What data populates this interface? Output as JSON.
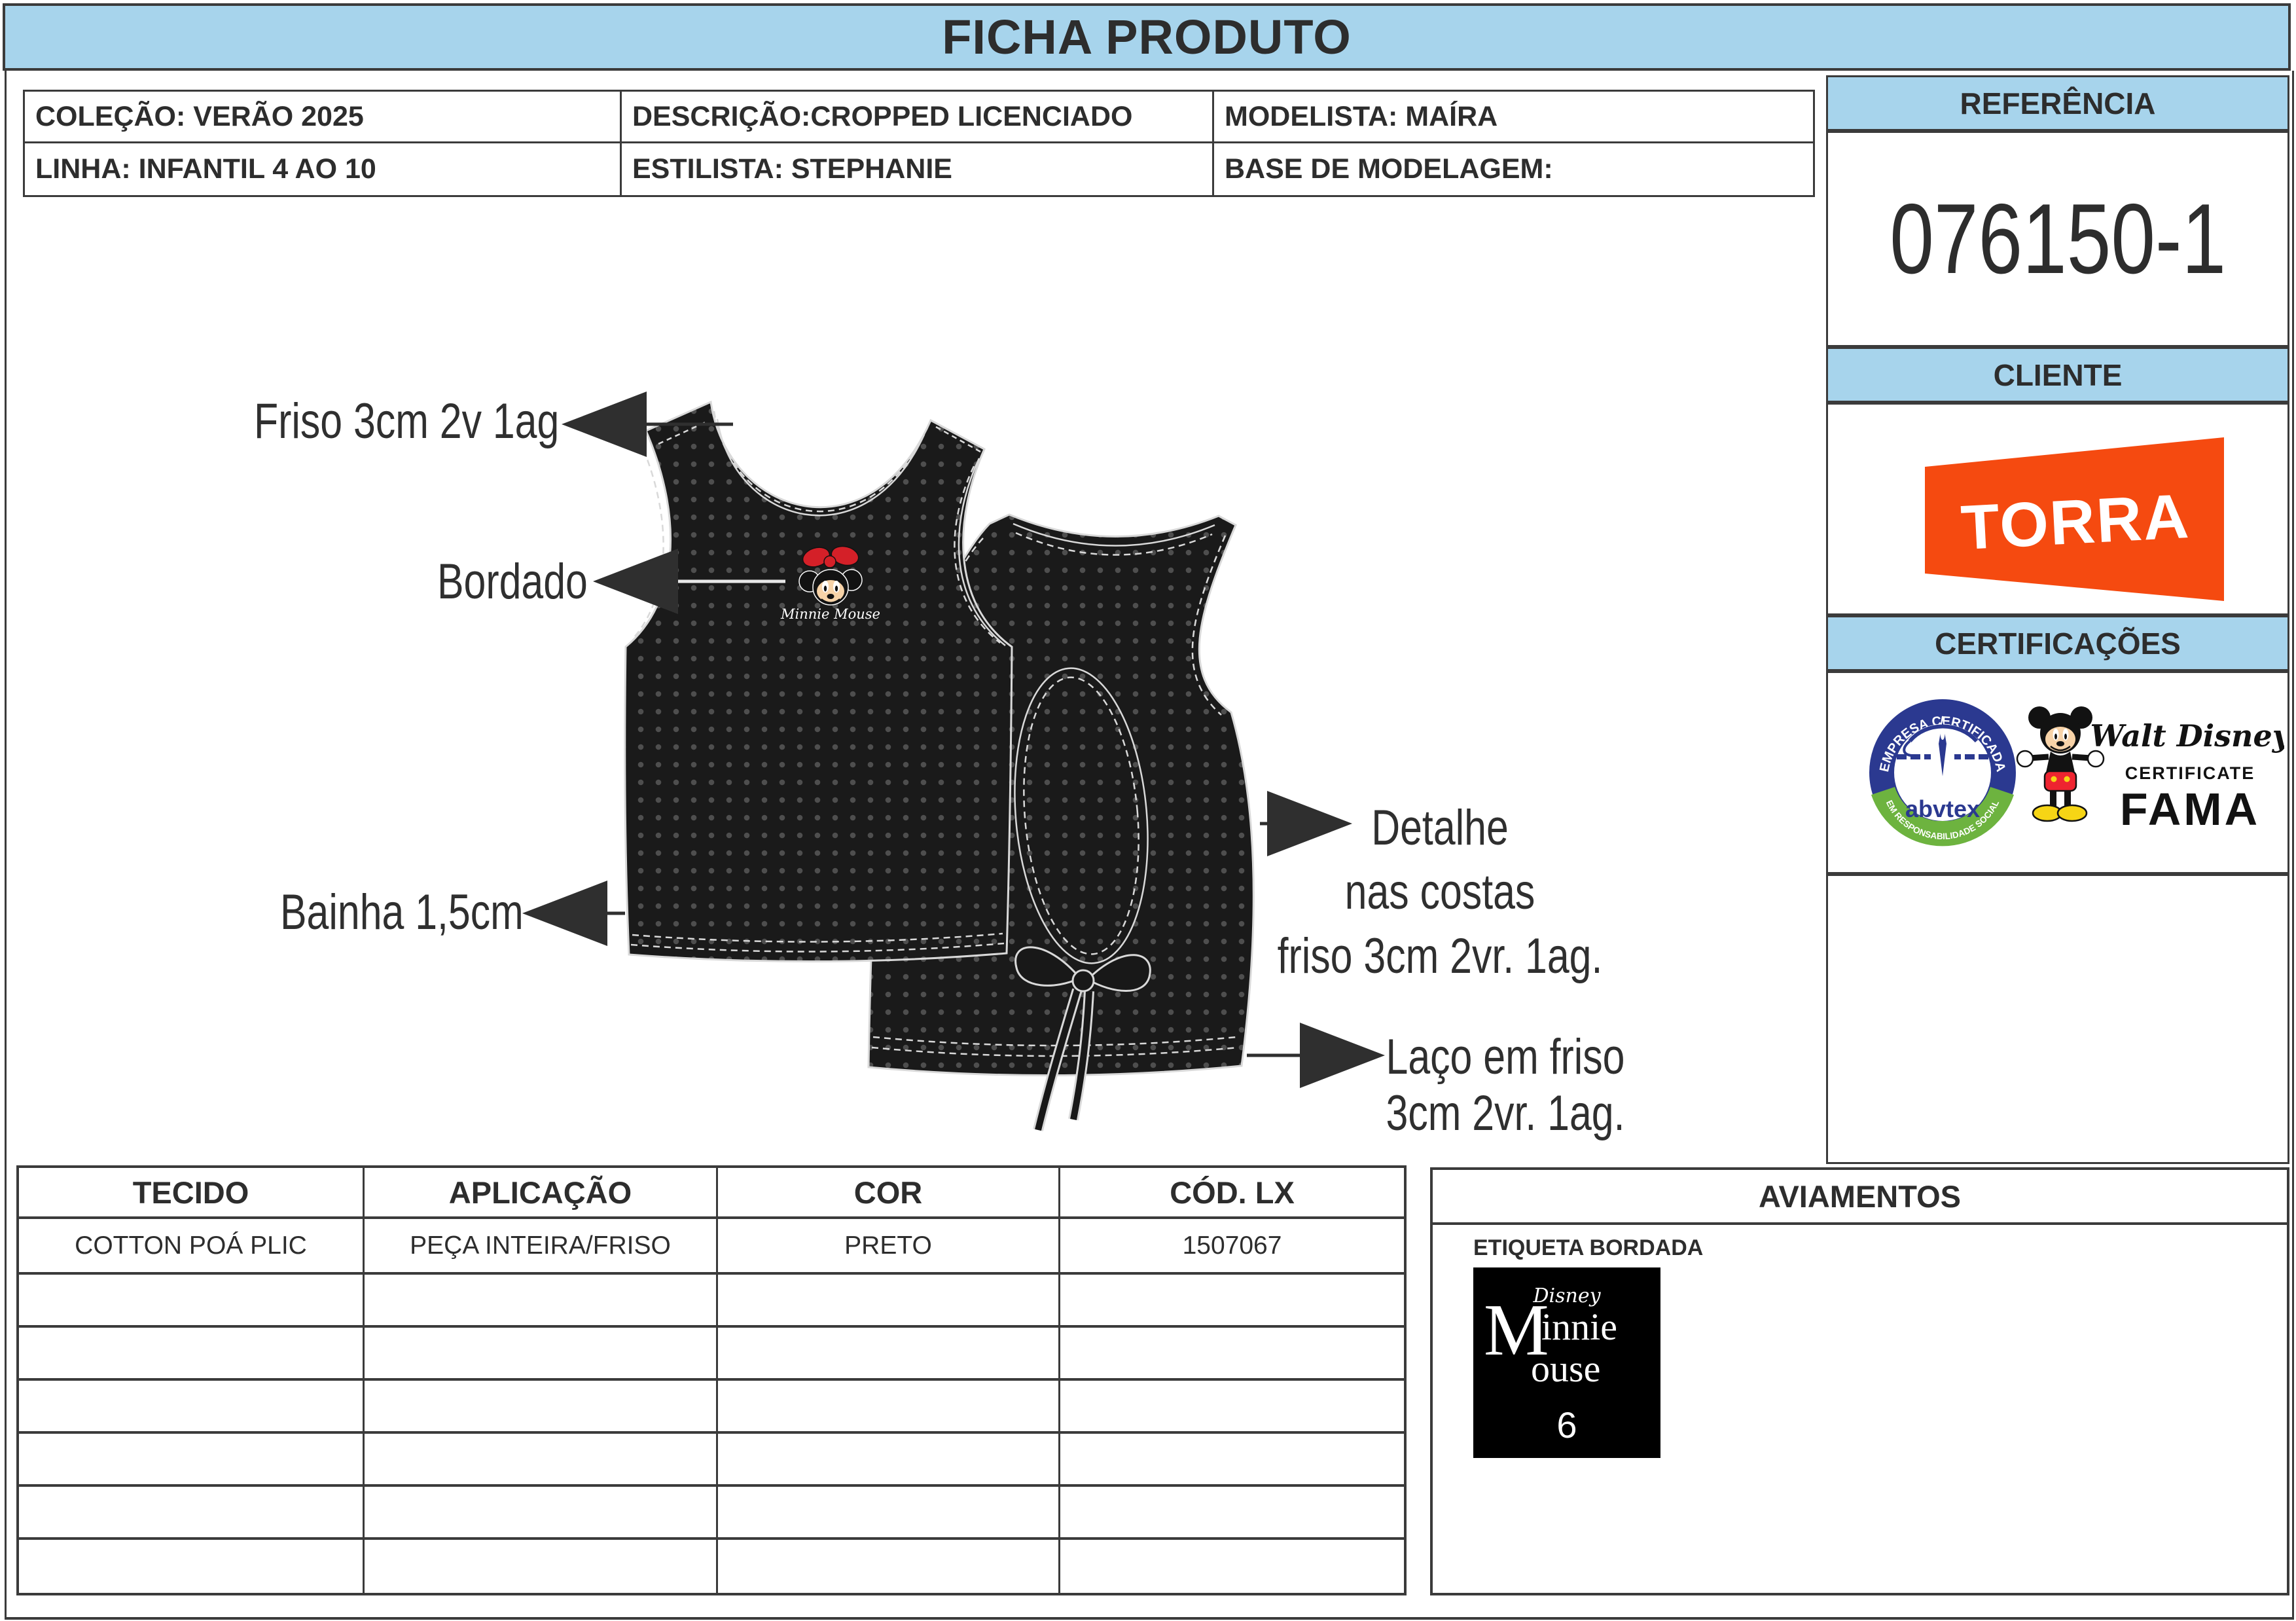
{
  "title_bar": "FICHA PRODUTO",
  "header_table": {
    "rows": [
      [
        "COLEÇÃO: VERÃO 2025",
        "DESCRIÇÃO:CROPPED LICENCIADO",
        "MODELISTA: MAÍRA"
      ],
      [
        "LINHA: INFANTIL 4 AO 10",
        "ESTILISTA: STEPHANIE",
        "BASE DE MODELAGEM:"
      ]
    ]
  },
  "sidebar": {
    "referencia": {
      "label": "REFERÊNCIA",
      "value": "076150-1"
    },
    "cliente": {
      "label": "CLIENTE",
      "logo_text": "TORRA"
    },
    "certificacoes": {
      "label": "CERTIFICAÇÕES",
      "abvtex": {
        "arc_top": "EMPRESA CERTIFICADA",
        "arc_bottom": "EM RESPONSABILIDADE SOCIAL",
        "name": "abvtex"
      },
      "fama": {
        "script": "Walt Disney",
        "line1": "CERTIFICATE",
        "line2": "FAMA"
      }
    }
  },
  "drawing": {
    "annotations": {
      "friso": "Friso 3cm 2v 1ag",
      "bordado": "Bordado",
      "bainha": "Bainha 1,5cm",
      "detalhe": [
        "Detalhe",
        "nas costas",
        "friso 3cm 2vr. 1ag."
      ],
      "laco": [
        "Laço em friso",
        "3cm 2vr. 1ag."
      ]
    },
    "embroidery": {
      "text": "Minnie Mouse"
    }
  },
  "materials_table": {
    "headers": [
      "TECIDO",
      "APLICAÇÃO",
      "COR",
      "CÓD. LX"
    ],
    "rows": [
      [
        "COTTON POÁ PLIC",
        "PEÇA INTEIRA/FRISO",
        "PRETO",
        "1507067"
      ],
      [
        "",
        "",
        "",
        ""
      ],
      [
        "",
        "",
        "",
        ""
      ],
      [
        "",
        "",
        "",
        ""
      ],
      [
        "",
        "",
        "",
        ""
      ],
      [
        "",
        "",
        "",
        ""
      ],
      [
        "",
        "",
        "",
        ""
      ]
    ]
  },
  "aviamentos": {
    "title": "AVIAMENTOS",
    "etiqueta": "ETIQUETA BORDADA",
    "label": {
      "brand": "Disney",
      "big": "M",
      "top": "innie",
      "bottom": "ouse",
      "size": "6"
    }
  },
  "colors": {
    "header_blue": "#a7d4ec",
    "border_gray": "#3b3b3b",
    "torra_orange": "#f54a10",
    "fabric_black": "#1a1a1a",
    "dot_gray": "#4e4e4e",
    "stitch_white": "#d9d9d9",
    "bow_red": "#d42028",
    "abvtex_navy": "#2b3990",
    "abvtex_green": "#6db33f",
    "mickey_red": "#ee2430",
    "mickey_yellow": "#f6d515"
  }
}
